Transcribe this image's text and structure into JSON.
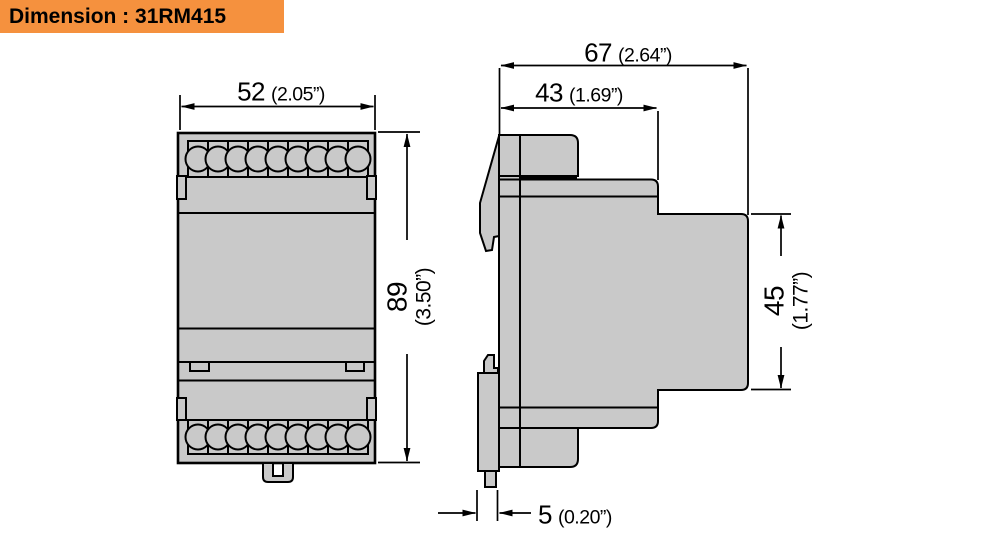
{
  "header": {
    "title": "Dimension : 31RM415"
  },
  "colors": {
    "header_bg": "#F5913E",
    "body_fill": "#C9C9C9",
    "line": "#000000",
    "background": "#FFFFFF"
  },
  "views": {
    "front": {
      "terminal_rows": 2,
      "terminals_per_row": 9
    },
    "side": {
      "description": "side profile with DIN-rail clip"
    }
  },
  "dimensions": {
    "front_width": {
      "mm": "52",
      "inch": "(2.05”)"
    },
    "front_height": {
      "mm": "89",
      "inch": "(3.50”)"
    },
    "side_total_depth": {
      "mm": "67",
      "inch": "(2.64”)"
    },
    "side_upper_depth": {
      "mm": "43",
      "inch": "(1.69”)"
    },
    "side_rear_height": {
      "mm": "45",
      "inch": "(1.77”)"
    },
    "side_clip_offset": {
      "mm": "5",
      "inch": "(0.20”)"
    }
  }
}
